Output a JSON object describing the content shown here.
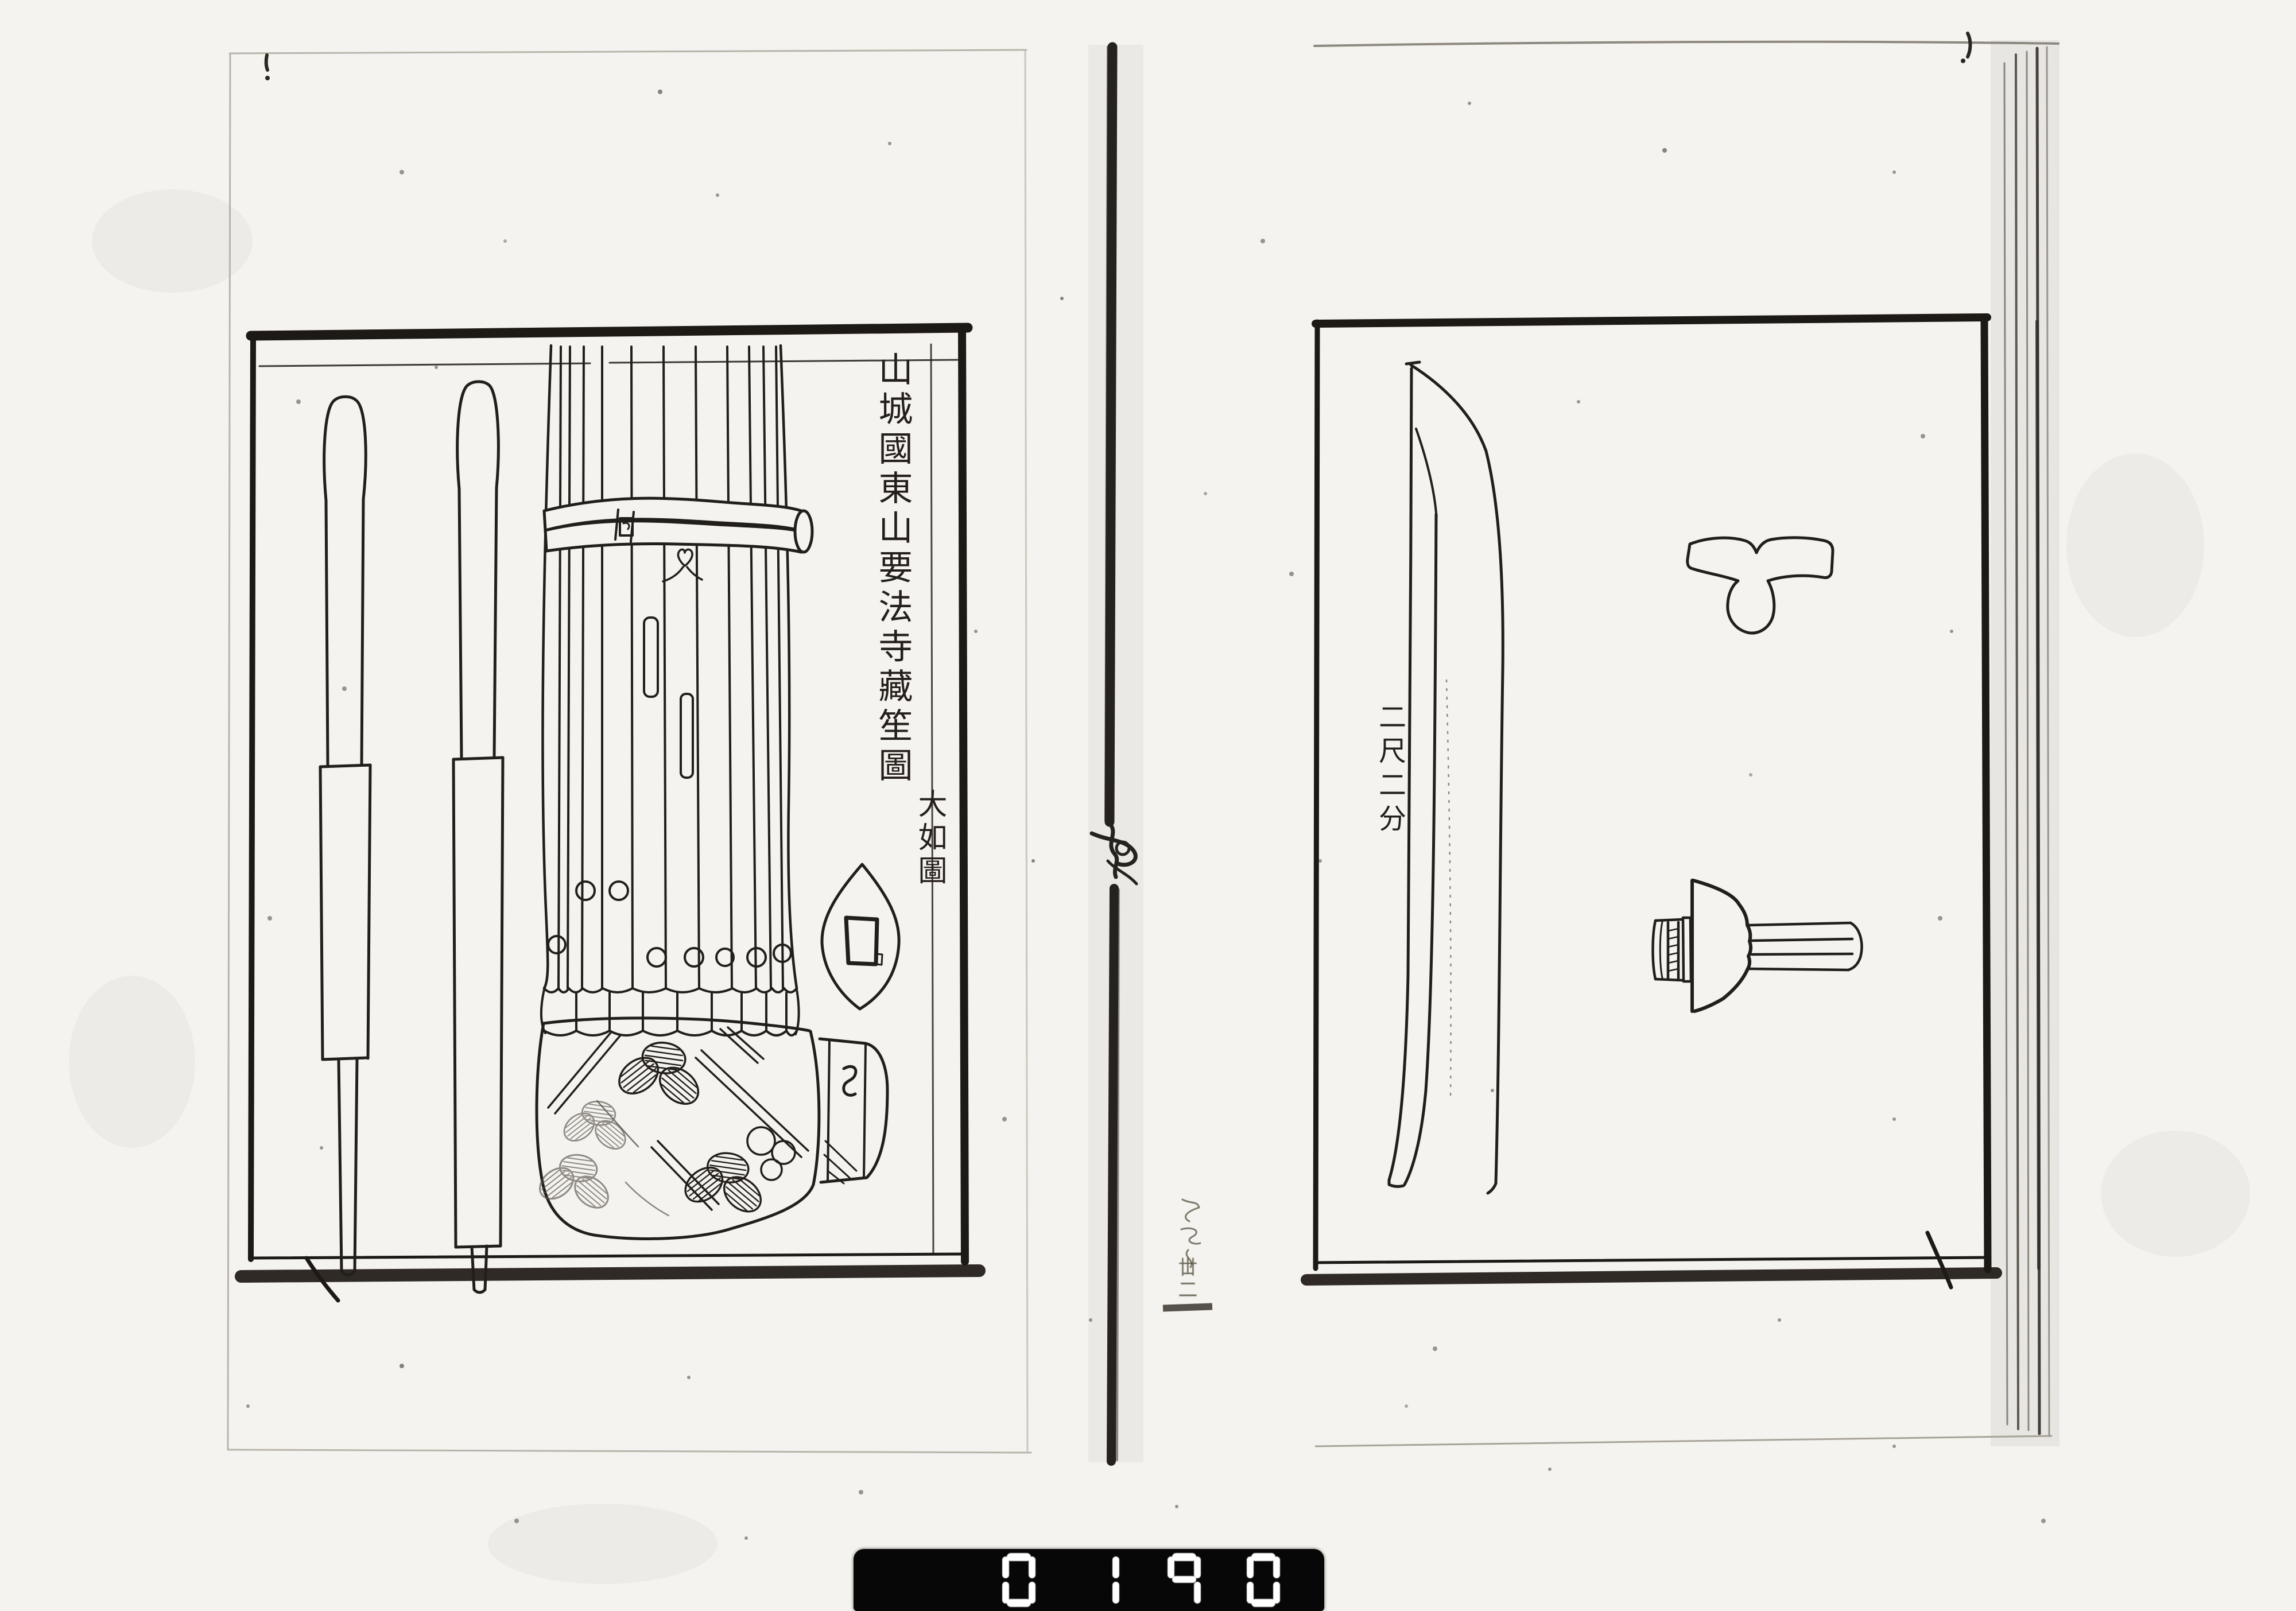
{
  "scan": {
    "left_page": {
      "title_vertical": "山城國東山要法寺藏笙圖",
      "size_note": "大如圖"
    },
    "right_page": {
      "measurement": "二尺二分"
    },
    "gutter_annotation": "丗二",
    "counter": {
      "digits": [
        "0",
        "1",
        "9",
        "0"
      ]
    },
    "colors": {
      "paper": "#f5f3ef",
      "ink": "#221e19",
      "counter_bg": "#070707",
      "counter_fg": "#ffffff"
    }
  }
}
